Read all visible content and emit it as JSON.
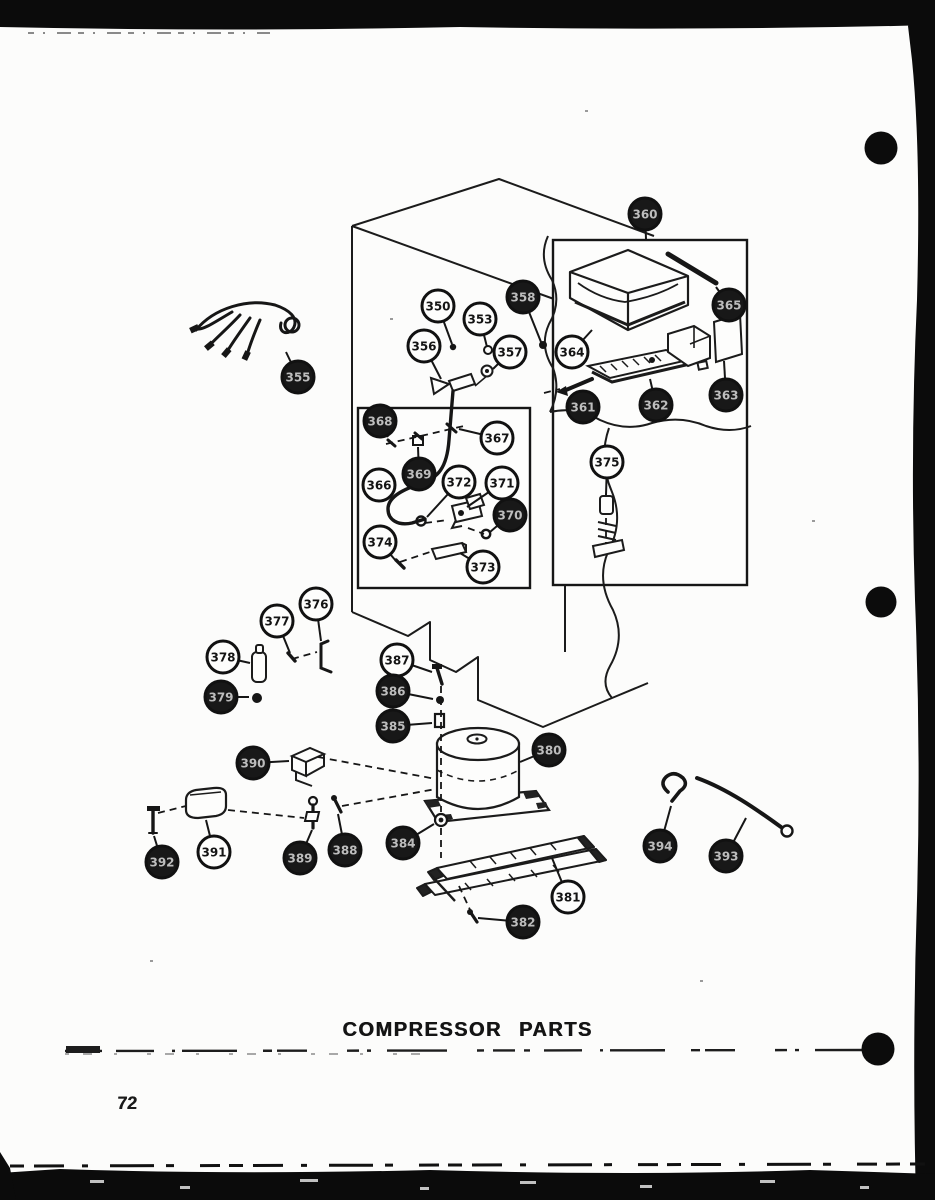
{
  "page": {
    "title": "COMPRESSOR PARTS",
    "page_number": "72"
  },
  "colors": {
    "ink": "#1b1b1b",
    "paper": "#fcfcfb"
  },
  "diagram": {
    "description": "Exploded parts view with numbered callout balloons",
    "balloons": [
      {
        "num": "350",
        "x": 438,
        "y": 306,
        "lx": 452,
        "ly": 344,
        "dark": false
      },
      {
        "num": "353",
        "x": 480,
        "y": 319,
        "lx": 487,
        "ly": 347,
        "dark": false
      },
      {
        "num": "358",
        "x": 523,
        "y": 297,
        "lx": 541,
        "ly": 342,
        "dark": true
      },
      {
        "num": "356",
        "x": 424,
        "y": 346,
        "lx": 441,
        "ly": 379,
        "dark": false
      },
      {
        "num": "357",
        "x": 510,
        "y": 352,
        "lx": 493,
        "ly": 369,
        "dark": false
      },
      {
        "num": "355",
        "x": 298,
        "y": 377,
        "lx": 286,
        "ly": 352,
        "dark": true
      },
      {
        "num": "360",
        "x": 645,
        "y": 214,
        "lx": 646,
        "ly": 239,
        "dark": true
      },
      {
        "num": "365",
        "x": 729,
        "y": 305,
        "lx": 716,
        "ly": 287,
        "dark": true
      },
      {
        "num": "364",
        "x": 572,
        "y": 352,
        "lx": 592,
        "ly": 330,
        "dark": false
      },
      {
        "num": "361",
        "x": 583,
        "y": 407,
        "lx": 578,
        "ly": 394,
        "dark": true
      },
      {
        "num": "362",
        "x": 656,
        "y": 405,
        "lx": 650,
        "ly": 379,
        "dark": true
      },
      {
        "num": "363",
        "x": 726,
        "y": 395,
        "lx": 724,
        "ly": 361,
        "dark": true
      },
      {
        "num": "368",
        "x": 380,
        "y": 421,
        "lx": 388,
        "ly": 437,
        "dark": true
      },
      {
        "num": "367",
        "x": 497,
        "y": 438,
        "lx": 459,
        "ly": 429,
        "dark": false
      },
      {
        "num": "369",
        "x": 419,
        "y": 474,
        "lx": 418,
        "ly": 447,
        "dark": true
      },
      {
        "num": "366",
        "x": 379,
        "y": 485,
        "lx": 395,
        "ly": 488,
        "dark": false
      },
      {
        "num": "372",
        "x": 459,
        "y": 482,
        "lx": 427,
        "ly": 517,
        "dark": false
      },
      {
        "num": "371",
        "x": 502,
        "y": 483,
        "lx": 467,
        "ly": 507,
        "dark": false
      },
      {
        "num": "370",
        "x": 510,
        "y": 515,
        "lx": 490,
        "ly": 532,
        "dark": true
      },
      {
        "num": "374",
        "x": 380,
        "y": 542,
        "lx": 396,
        "ly": 561,
        "dark": false
      },
      {
        "num": "373",
        "x": 483,
        "y": 567,
        "lx": 460,
        "ly": 553,
        "dark": false
      },
      {
        "num": "375",
        "x": 607,
        "y": 462,
        "lx": 606,
        "ly": 495,
        "dark": false
      },
      {
        "num": "376",
        "x": 316,
        "y": 604,
        "lx": 321,
        "ly": 641,
        "dark": false
      },
      {
        "num": "377",
        "x": 277,
        "y": 621,
        "lx": 290,
        "ly": 653,
        "dark": false
      },
      {
        "num": "378",
        "x": 223,
        "y": 657,
        "lx": 250,
        "ly": 663,
        "dark": false
      },
      {
        "num": "379",
        "x": 221,
        "y": 697,
        "lx": 249,
        "ly": 697,
        "dark": true
      },
      {
        "num": "387",
        "x": 397,
        "y": 660,
        "lx": 432,
        "ly": 672,
        "dark": false
      },
      {
        "num": "386",
        "x": 393,
        "y": 691,
        "lx": 433,
        "ly": 699,
        "dark": true
      },
      {
        "num": "385",
        "x": 393,
        "y": 726,
        "lx": 432,
        "ly": 723,
        "dark": true
      },
      {
        "num": "380",
        "x": 549,
        "y": 750,
        "lx": 520,
        "ly": 762,
        "dark": true
      },
      {
        "num": "390",
        "x": 253,
        "y": 763,
        "lx": 289,
        "ly": 761,
        "dark": true
      },
      {
        "num": "391",
        "x": 214,
        "y": 852,
        "lx": 206,
        "ly": 820,
        "dark": false
      },
      {
        "num": "392",
        "x": 162,
        "y": 862,
        "lx": 154,
        "ly": 836,
        "dark": true
      },
      {
        "num": "389",
        "x": 300,
        "y": 858,
        "lx": 312,
        "ly": 830,
        "dark": true
      },
      {
        "num": "388",
        "x": 345,
        "y": 850,
        "lx": 338,
        "ly": 814,
        "dark": true
      },
      {
        "num": "384",
        "x": 403,
        "y": 843,
        "lx": 434,
        "ly": 824,
        "dark": true
      },
      {
        "num": "381",
        "x": 568,
        "y": 897,
        "lx": 552,
        "ly": 858,
        "dark": false
      },
      {
        "num": "382",
        "x": 523,
        "y": 922,
        "lx": 478,
        "ly": 918,
        "dark": true
      },
      {
        "num": "394",
        "x": 660,
        "y": 846,
        "lx": 671,
        "ly": 806,
        "dark": true
      },
      {
        "num": "393",
        "x": 726,
        "y": 856,
        "lx": 746,
        "ly": 818,
        "dark": true
      }
    ]
  }
}
